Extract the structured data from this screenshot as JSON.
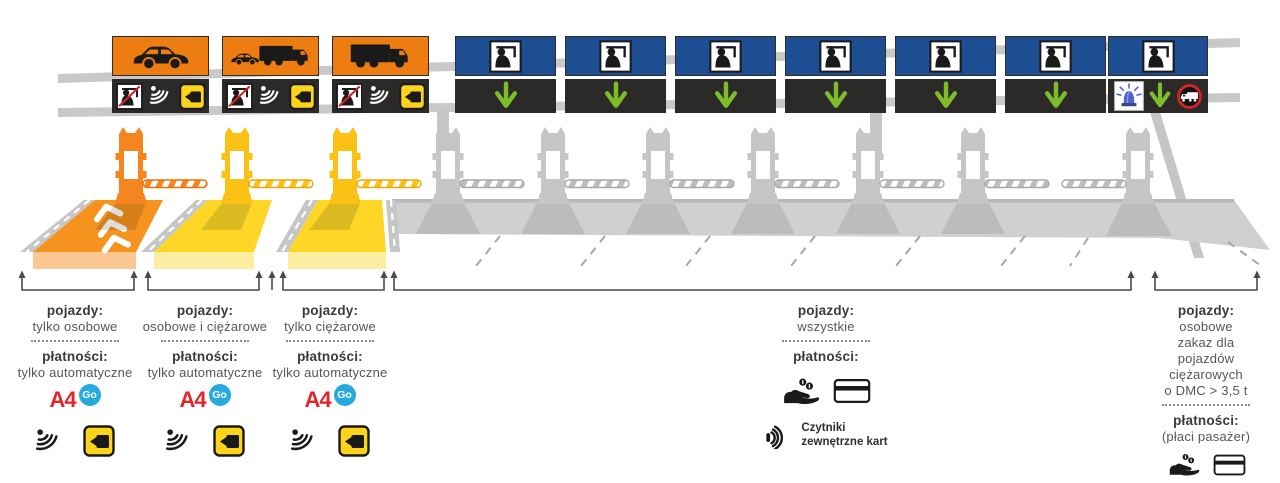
{
  "diagram": "toll-plaza-lanes",
  "signs": {
    "lanes": [
      {
        "lane": 1,
        "panel_color": "orange",
        "vehicle_icon": "car-icon",
        "service_icons": [
          "no-toll-collector-icon",
          "transponder-waves-icon",
          "videotoll-camera-icon"
        ]
      },
      {
        "lane": 2,
        "panel_color": "orange",
        "vehicle_icon": "car-and-truck-icon",
        "service_icons": [
          "no-toll-collector-icon",
          "transponder-waves-icon",
          "videotoll-camera-icon"
        ]
      },
      {
        "lane": 3,
        "panel_color": "orange",
        "vehicle_icon": "truck-icon",
        "service_icons": [
          "no-toll-collector-icon",
          "transponder-waves-icon",
          "videotoll-camera-icon"
        ]
      },
      {
        "lane": 4,
        "panel_color": "blue",
        "vehicle_icon": "toll-collector-icon",
        "service_icons": [
          "down-arrow-icon"
        ]
      },
      {
        "lane": 5,
        "panel_color": "blue",
        "vehicle_icon": "toll-collector-icon",
        "service_icons": [
          "down-arrow-icon"
        ]
      },
      {
        "lane": 6,
        "panel_color": "blue",
        "vehicle_icon": "toll-collector-icon",
        "service_icons": [
          "down-arrow-icon"
        ]
      },
      {
        "lane": 7,
        "panel_color": "blue",
        "vehicle_icon": "toll-collector-icon",
        "service_icons": [
          "down-arrow-icon"
        ]
      },
      {
        "lane": 8,
        "panel_color": "blue",
        "vehicle_icon": "toll-collector-icon",
        "service_icons": [
          "down-arrow-icon"
        ]
      },
      {
        "lane": 9,
        "panel_color": "blue",
        "vehicle_icon": "toll-collector-icon",
        "service_icons": [
          "down-arrow-icon"
        ]
      },
      {
        "lane": 10,
        "panel_color": "blue",
        "vehicle_icon": "toll-collector-icon",
        "service_icons": [
          "emergency-beacon-icon",
          "down-arrow-icon",
          "no-trucks-icon"
        ]
      }
    ]
  },
  "labels": [
    {
      "vehicles_heading": "pojazdy:",
      "vehicle_lines": [
        "tylko osobowe"
      ],
      "payments_heading": "płatności:",
      "payment_lines": [
        "tylko automatyczne"
      ],
      "logo_a4": "A4",
      "logo_go": "Go",
      "icons": [
        "transponder-waves-icon",
        "videotoll-camera-icon"
      ]
    },
    {
      "vehicles_heading": "pojazdy:",
      "vehicle_lines": [
        "osobowe i ciężarowe"
      ],
      "payments_heading": "płatności:",
      "payment_lines": [
        "tylko automatyczne"
      ],
      "logo_a4": "A4",
      "logo_go": "Go",
      "icons": [
        "transponder-waves-icon",
        "videotoll-camera-icon"
      ]
    },
    {
      "vehicles_heading": "pojazdy:",
      "vehicle_lines": [
        "tylko ciężarowe"
      ],
      "payments_heading": "płatności:",
      "payment_lines": [
        "tylko automatyczne"
      ],
      "logo_a4": "A4",
      "logo_go": "Go",
      "icons": [
        "transponder-waves-icon",
        "videotoll-camera-icon"
      ]
    },
    {
      "vehicles_heading": "pojazdy:",
      "vehicle_lines": [
        "wszystkie"
      ],
      "payments_heading": "płatności:",
      "payment_lines": [],
      "icons": [
        "hand-coins-icon",
        "payment-card-icon"
      ],
      "reader_icon": "contactless-reader-icon",
      "reader_note_lines": [
        "Czytniki",
        "zewnętrzne kart"
      ]
    },
    {
      "vehicles_heading": "pojazdy:",
      "vehicle_lines": [
        "osobowe",
        "zakaz dla",
        "pojazdów",
        "ciężarowych",
        "o DMC > 3,5 t"
      ],
      "payments_heading": "płatności:",
      "payment_lines": [
        "(płaci pasażer)"
      ],
      "icons": [
        "hand-coins-icon",
        "payment-card-icon"
      ]
    }
  ],
  "colors": {
    "orange_sign": "#ee7d11",
    "blue_sign": "#1c4e91",
    "panel_black": "#2b2a29",
    "arrow_green": "#7fbc29",
    "booth_orange": "#f5861f",
    "booth_yellow": "#fcc115",
    "structure_gray": "#c6c6c5",
    "lane_orange": "#f6921e",
    "lane_yellow": "#fdd626",
    "a4_red": "#e52329",
    "go_blue": "#27a9e0",
    "no_entry_red": "#d2232a",
    "beacon_blue": "#4f63cf",
    "text_dark": "#3a3a39",
    "text_gray": "#575756"
  }
}
